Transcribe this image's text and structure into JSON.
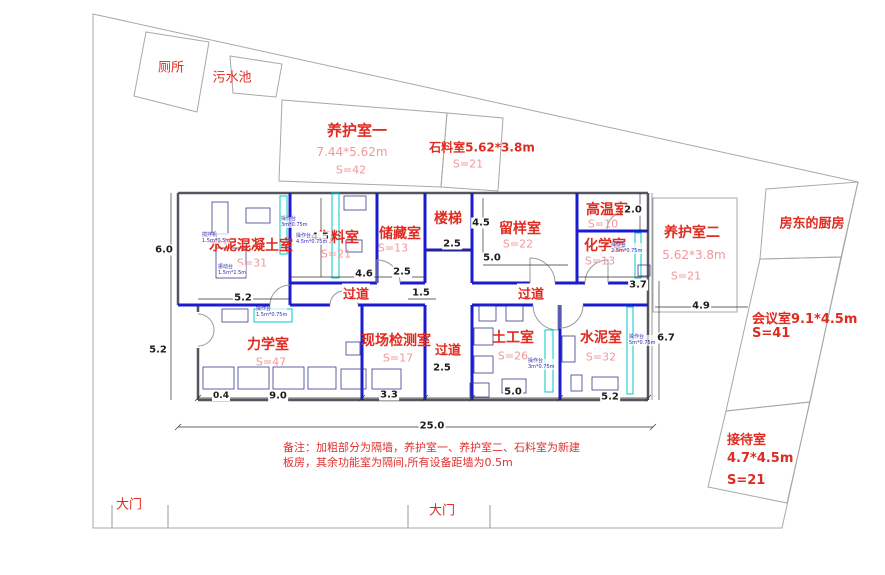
{
  "outbuildings": {
    "toilet": {
      "name": "厕所"
    },
    "sewage": {
      "name": "污水池"
    },
    "curing1": {
      "name": "养护室一",
      "dims": "7.44*5.62m",
      "area": "S=42"
    },
    "stone": {
      "name": "石料室5.62*3.8m",
      "area": "S=21"
    },
    "curing2": {
      "name": "养护室二",
      "dims": "5.62*3.8m",
      "area": "S=21"
    },
    "kitchen": {
      "name": "房东的厨房"
    },
    "meeting": {
      "name": "会议室9.1*4.5m",
      "area": "S=41"
    },
    "reception": {
      "name": "接待室",
      "dims": "4.7*4.5m",
      "area": "S=21"
    }
  },
  "rooms": {
    "cement_concrete": {
      "name": "水泥混凝土室",
      "area": "S=31"
    },
    "aggregate": {
      "name": "集料室",
      "area": "S=21"
    },
    "storage": {
      "name": "储藏室",
      "area": "S=13"
    },
    "stairs": {
      "name": "楼梯"
    },
    "sample": {
      "name": "留样室",
      "area": "S=22"
    },
    "high_temp": {
      "name": "高温室",
      "area": "S=10"
    },
    "chemistry": {
      "name": "化学室",
      "area": "S=13"
    },
    "mechanics": {
      "name": "力学室",
      "area": "S=47"
    },
    "field_test": {
      "name": "现场检测室",
      "area": "S=17"
    },
    "soil": {
      "name": "土工室",
      "area": "S=26"
    },
    "cement": {
      "name": "水泥室",
      "area": "S=32"
    }
  },
  "corridors": {
    "c1": "过道",
    "c2": "过道",
    "c3": "过道"
  },
  "gates": {
    "g1": "大门",
    "g2": "大门"
  },
  "dimensions": {
    "left_top": "6.0",
    "left_bottom": "5.2",
    "cement_w": "5.2",
    "agg_h": "4.5",
    "agg_w": "4.6",
    "storage_w": "2.5",
    "stair_w": "2.5",
    "jog": "1.5",
    "sample_h": "4.5",
    "sample_w": "5.0",
    "hitemp_h": "2.0",
    "chem_w": "3.7",
    "east_gap": "4.9",
    "east_h": "6.7",
    "mech_offset": "0.4",
    "mech_w": "9.0",
    "field_w": "3.3",
    "corr_w": "2.5",
    "soil_w": "5.0",
    "cementrm_w": "5.2",
    "total_w": "25.0"
  },
  "equipment": {
    "mixer": {
      "name": "搅拌机",
      "size": "1.5m*0.5m"
    },
    "shaker": {
      "name": "振动台",
      "size": "1.5m*1.5m"
    },
    "bench3": {
      "name": "操作台",
      "size": "3m*0.75m"
    },
    "bench45": {
      "name": "操作台",
      "size": "4.5m*0.75m"
    },
    "bench15": {
      "name": "操作台",
      "size": "1.5m*0.75m"
    },
    "bench3b": {
      "name": "操作台",
      "size": "3m*0.75m"
    },
    "bench5": {
      "name": "操作台",
      "size": "5m*0.75m"
    },
    "bench25": {
      "name": "操作台",
      "size": "2.5m*0.75m"
    }
  },
  "note": "备注：加粗部分为隔墙，养护室一、养护室二、石料室为新建板房，其余功能室为隔间,所有设备距墙为0.5m",
  "palette": {
    "wall_blue": "#1b1bd0",
    "counter_cyan": "#00c8c8",
    "label_red": "#e02b20",
    "label_pink": "#f0989a",
    "dim_black": "#1c1c1c",
    "boundary_gray": "#a8a8a8"
  }
}
